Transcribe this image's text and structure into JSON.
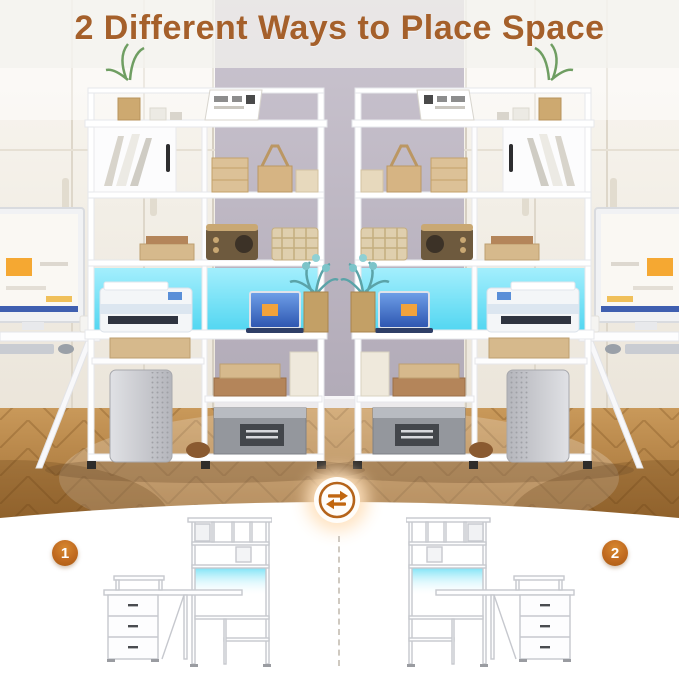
{
  "title": "2 Different Ways to Place Space",
  "diagrams": [
    {
      "number": "1"
    },
    {
      "number": "2"
    }
  ],
  "icons": {
    "swap": "swap-arrows-icon"
  },
  "colors": {
    "title": "#A5602B",
    "badge": "#C06A20",
    "swap_ring": "#B5641B",
    "led": "#39D6F2",
    "wall": "#B2ABB8",
    "floor": "#B07B3C"
  }
}
